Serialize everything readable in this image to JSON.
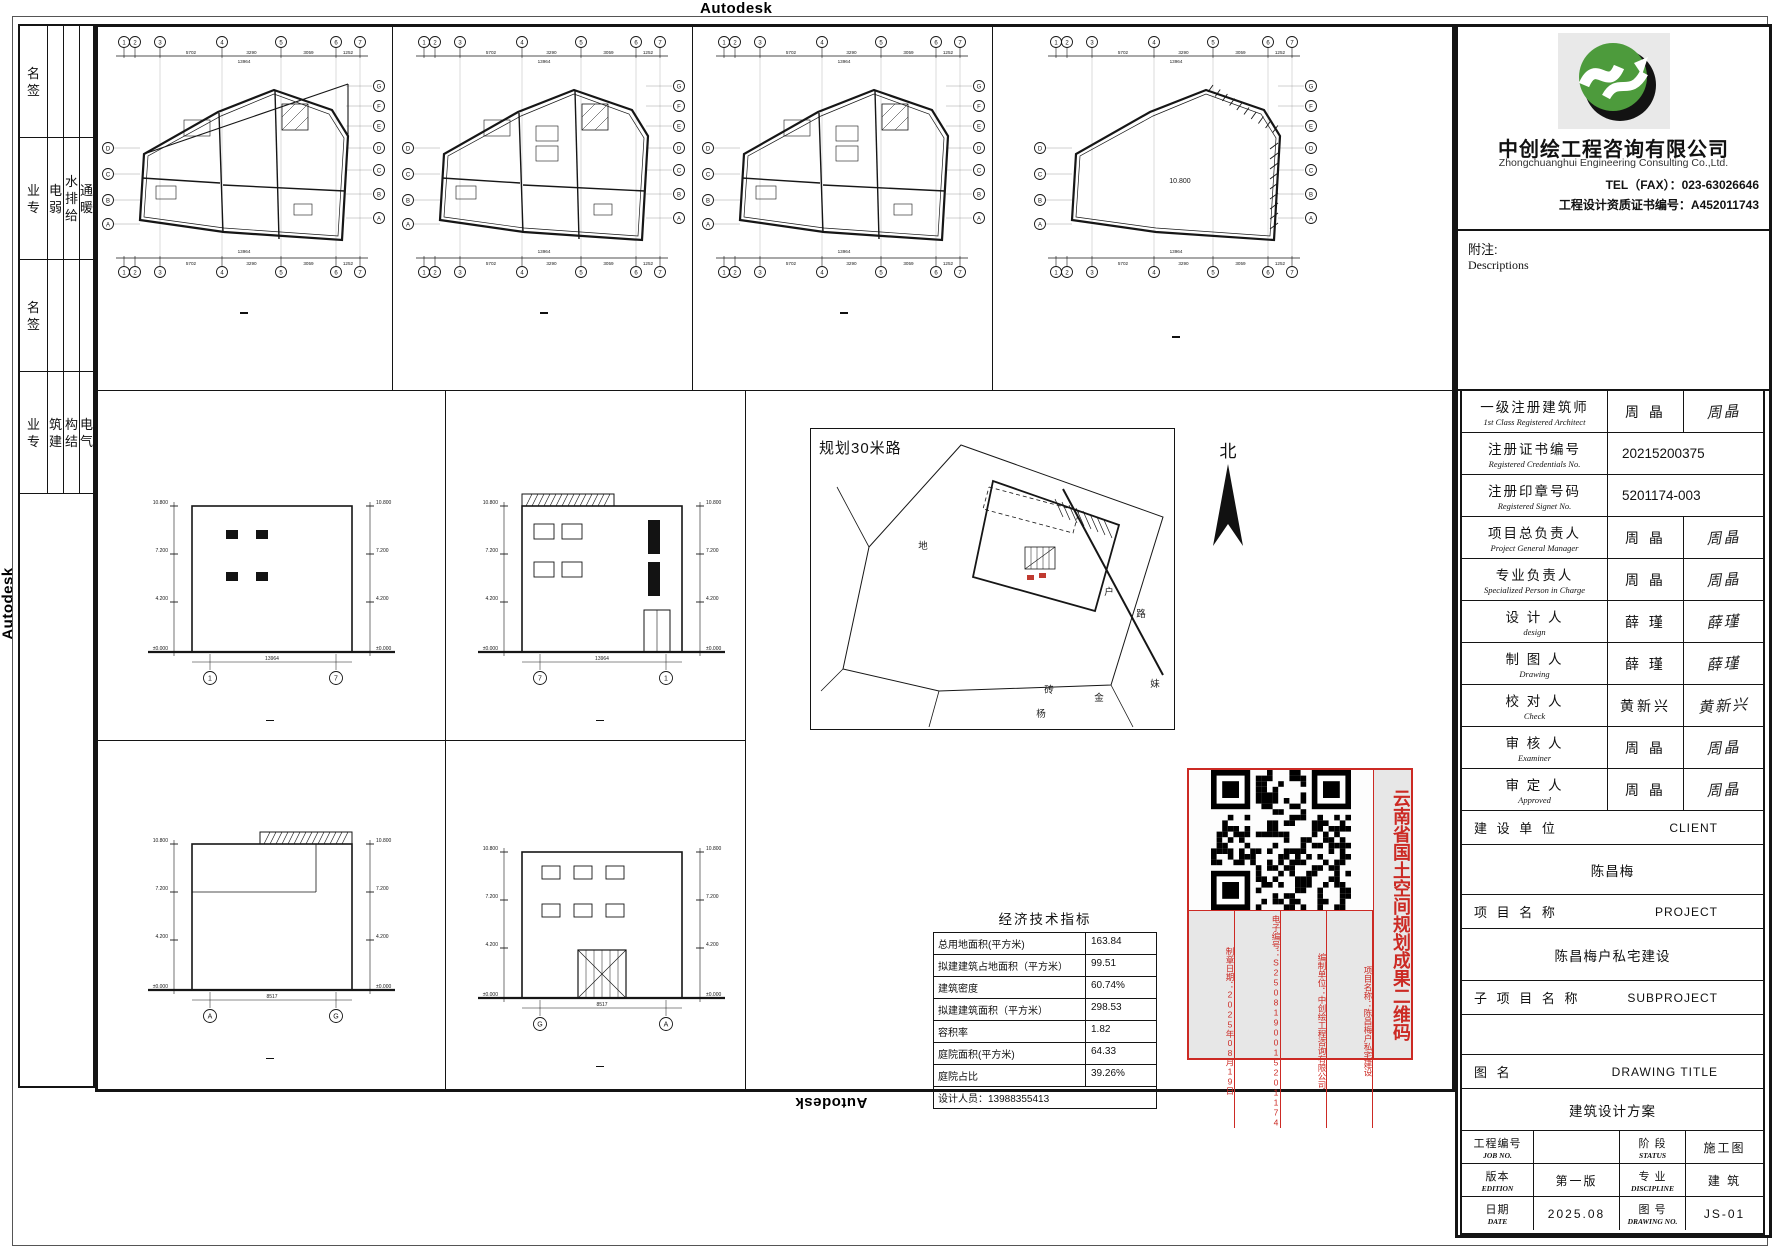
{
  "watermarks": {
    "top": "Autodesk",
    "bottom": "Autodesk",
    "left": "Autodesk",
    "right": "Autodesk"
  },
  "left_strip": {
    "sign": "名签",
    "prof": "业专",
    "group1": [
      "电弱",
      "水排给",
      "通暖"
    ],
    "group2": [
      "筑建",
      "构结",
      "电气"
    ]
  },
  "plan_axes": {
    "top": [
      "1",
      "2",
      "3",
      "4",
      "5",
      "6",
      "7"
    ],
    "right": [
      "G",
      "F",
      "E",
      "D",
      "C",
      "B",
      "A"
    ],
    "left": [
      "D",
      "C",
      "B",
      "A"
    ]
  },
  "plan_dims": [
    "5702",
    "3290",
    "3059",
    "1252"
  ],
  "dim_total": "13964",
  "roof_level_label": "10.800",
  "plans": [
    {
      "title": "一层平面图",
      "scale": "1:100",
      "area_lines": [
        "本层建筑面积:99.51m²",
        "总建筑面积:298.53m²"
      ]
    },
    {
      "title": "二层平面图",
      "scale": "1:100",
      "area_lines": [
        "本层建筑面积:99.51m²",
        "总建筑面积:298.53m²"
      ]
    },
    {
      "title": "三层平面图",
      "scale": "1:100",
      "area_lines": [
        "本层建筑面积:99.51m²",
        "总建筑面积:298.53m²"
      ]
    },
    {
      "title": "屋顶平面图",
      "scale": "1:100",
      "area_lines": []
    }
  ],
  "levels": [
    "10.800",
    "7.200",
    "4.200",
    "±0.000"
  ],
  "elevations": [
    {
      "title": "①-⑦轴立面图",
      "scale": "1:100",
      "bubbles": [
        "1",
        "7"
      ],
      "bottom_dim": "13964"
    },
    {
      "title": "⑦-①轴立面图",
      "scale": "1:100",
      "bubbles": [
        "7",
        "1"
      ],
      "bottom_dim": "13964"
    },
    {
      "title": "Ⓐ-Ⓖ轴立面图",
      "scale": "1:100",
      "bubbles": [
        "A",
        "G"
      ],
      "bottom_dim": "8517"
    },
    {
      "title": "Ⓖ-Ⓐ轴立面图",
      "scale": "1:100",
      "bubbles": [
        "G",
        "A"
      ],
      "bottom_dim": "8517"
    }
  ],
  "site": {
    "road_label": "规划30米路",
    "north_label": "北",
    "labels": [
      "地",
      "砖",
      "杨",
      "金",
      "妹",
      "户",
      "路"
    ]
  },
  "econ": {
    "title": "经济技术指标",
    "rows": [
      [
        "总用地面积(平方米)",
        "163.84"
      ],
      [
        "拟建建筑占地面积（平方米）",
        "99.51"
      ],
      [
        "建筑密度",
        "60.74%"
      ],
      [
        "拟建建筑面积（平方米）",
        "298.53"
      ],
      [
        "容积率",
        "1.82"
      ],
      [
        "庭院面积(平方米)",
        "64.33"
      ],
      [
        "庭院占比",
        "39.26%"
      ]
    ],
    "footer": "设计人员：13988355413"
  },
  "stamp": {
    "columns": [
      "制章日期：2025年08月19日",
      "电子编号：S2508190015201174",
      "编制单位：中创绘工程咨询有限公司",
      "项目名称：陈昌梅户私宅建设"
    ],
    "side_text": "云南省国土空间规划成果二维码",
    "red": "#cc2a24"
  },
  "company": {
    "name": "中创绘工程咨询有限公司",
    "name_en": "Zhongchuanghui Engineering Consulting  Co.,Ltd.",
    "tel": "TEL（FAX）：023-63026646",
    "cert": "工程设计资质证书编号：A452011743",
    "notes_cn": "附注:",
    "notes_en": "Descriptions"
  },
  "personnel": [
    {
      "cn": "一级注册建筑师",
      "en": "1st Class Registered Architect",
      "name": "周 晶",
      "sig": "周晶"
    },
    {
      "cn": "注册证书编号",
      "en": "Registered Credentials No.",
      "value": "20215200375"
    },
    {
      "cn": "注册印章号码",
      "en": "Registered Signet No.",
      "value": "5201174-003"
    },
    {
      "cn": "项目总负责人",
      "en": "Project General Manager",
      "name": "周 晶",
      "sig": "周晶"
    },
    {
      "cn": "专业负责人",
      "en": "Specialized Person in Charge",
      "name": "周 晶",
      "sig": "周晶"
    },
    {
      "cn": "设 计 人",
      "en": "design",
      "name": "薛 瑾",
      "sig": "薛瑾"
    },
    {
      "cn": "制 图 人",
      "en": "Drawing",
      "name": "薛 瑾",
      "sig": "薛瑾"
    },
    {
      "cn": "校 对 人",
      "en": "Check",
      "name": "黄新兴",
      "sig": "黄新兴"
    },
    {
      "cn": "审 核 人",
      "en": "Examiner",
      "name": "周 晶",
      "sig": "周晶"
    },
    {
      "cn": "审 定 人",
      "en": "Approved",
      "name": "周 晶",
      "sig": "周晶"
    }
  ],
  "project_rows": [
    {
      "label": "建 设 单 位",
      "en": "CLIENT",
      "value": "陈昌梅"
    },
    {
      "label": "项 目 名 称",
      "en": "PROJECT",
      "value": "陈昌梅户私宅建设"
    },
    {
      "label": "子 项 目 名 称",
      "en": "SUBPROJECT",
      "value": ""
    },
    {
      "label": "图 名",
      "en": "DRAWING TITLE",
      "value": "建筑设计方案"
    }
  ],
  "bottom_grid": [
    [
      {
        "cn": "工程编号",
        "en": "JOB NO."
      },
      {
        "val": ""
      },
      {
        "cn": "阶 段",
        "en": "STATUS"
      },
      {
        "val": "施工图"
      }
    ],
    [
      {
        "cn": "版本",
        "en": "EDITION"
      },
      {
        "val": "第一版"
      },
      {
        "cn": "专 业",
        "en": "DISCIPLINE"
      },
      {
        "val": "建 筑"
      }
    ],
    [
      {
        "cn": "日期",
        "en": "DATE"
      },
      {
        "val": "2025.08"
      },
      {
        "cn": "图 号",
        "en": "DRAWING NO."
      },
      {
        "val": "JS-01"
      }
    ]
  ]
}
